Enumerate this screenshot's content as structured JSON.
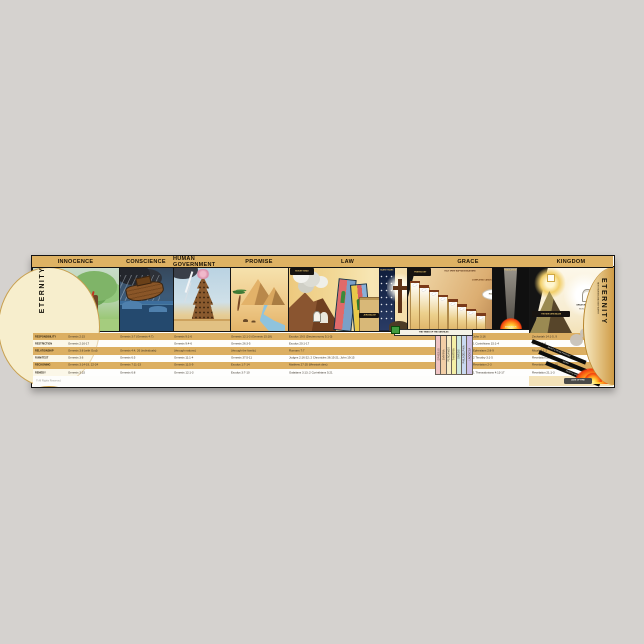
{
  "page": {
    "background": "#d5d2cf"
  },
  "poster": {
    "eternity_left": "ETERNITY",
    "eternity_right": "ETERNITY",
    "eternity_right_sub": "NEW HEAVEN AND NEW EARTH",
    "copyright": "© All Rights Reserved.",
    "colors": {
      "header_gold": "#deb263",
      "row_gold": "#dcaf62",
      "cream": "#f7eecd"
    }
  },
  "sections": [
    {
      "label": "INNOCENCE"
    },
    {
      "label": "CONSCIENCE"
    },
    {
      "label": "HUMAN GOVERNMENT"
    },
    {
      "label": "PROMISE"
    },
    {
      "label": "LAW"
    },
    {
      "label": "GRACE"
    },
    {
      "label": "KINGDOM"
    }
  ],
  "table": {
    "row_labels": [
      "RESPONSIBILITY",
      "RESTRICTION",
      "RELATIONSHIP",
      "RUIN/TEST",
      "RECKONING",
      "REMEDY"
    ],
    "columns": [
      {
        "section": "INNOCENCE",
        "refs": [
          "Genesis 2:15",
          "Genesis 2:16-17",
          "Genesis 3:8 (with God)",
          "Genesis 3:6",
          "Genesis 3:14-19, 22-24",
          "Genesis 3:15"
        ]
      },
      {
        "section": "CONSCIENCE",
        "refs": [
          "Genesis 3:7 (Genesis 4:7)",
          "",
          "Genesis 4:4, 26 (individuals)",
          "Genesis 6:5",
          "Genesis 7:11-23",
          "Genesis 6:8"
        ]
      },
      {
        "section": "HUMAN GOVERNMENT",
        "refs": [
          "Genesis 9:1-6",
          "Genesis 9:4-6",
          "(through nations)",
          "Genesis 11:1-4",
          "Genesis 11:5-9",
          "Genesis 12:1-3"
        ]
      },
      {
        "section": "PROMISE",
        "refs": [
          "Genesis 12:1-3 (Genesis 15:18)",
          "Genesis 26:3-5",
          "(through the family)",
          "Genesis 37:5-11",
          "Exodus 1:7-14",
          "Exodus 3:7-10"
        ]
      },
      {
        "section": "LAW",
        "refs": [
          "Exodus 19:5 (Deuteronomy 5:1-3)",
          "Exodus 20:1-17",
          "Romans 7:7",
          "Judges 2:16-22; 2 Chronicles 36:15-21; John 19:15",
          "Matthew 27:35 (Messiah dies)",
          "Galatians 3:13; 2 Corinthians 5:21"
        ]
      },
      {
        "section": "GRACE",
        "refs": [
          "John 3:16",
          "1 Corinthians 15:1-4",
          "Ephesians 2:8-9",
          "2 Timothy 3:1-5",
          "Revelation 2-3",
          "1 Thessalonians 4:13-17"
        ]
      },
      {
        "section": "KINGDOM",
        "refs": [
          "Zechariah 14:1-5, 9",
          "Isaiah 11:4",
          "Micah 4:1-2",
          "Revelation 20:7-9a",
          "Revelation 20:9b-10",
          "Revelation 21:1-3"
        ]
      }
    ]
  },
  "law": {
    "mount_sinai": "MOUNT SINAI",
    "jerusalem": "JERUSALEM",
    "silent_years": "SILENT YEARS"
  },
  "grace": {
    "pentecost": "PENTECOST",
    "spirit_line": "HOLY SPIRIT BAPTIZES BELIEVERS",
    "canon_line": "COMPLETED CANON",
    "rapture": "RAPTURE",
    "tribulation": "TRIBULATION",
    "armageddon": "ARMAGEDDON",
    "gentiles_band": "THE TIMES OF THE GENTILES",
    "churches": [
      {
        "name": "EPHESUS",
        "color": "#efc3c3"
      },
      {
        "name": "SMYRNA",
        "color": "#f3cfa6"
      },
      {
        "name": "PERGAMOS",
        "color": "#f6ecc5"
      },
      {
        "name": "THYATIRA",
        "color": "#f4efa5"
      },
      {
        "name": "SARDIS",
        "color": "#cfe9df"
      },
      {
        "name": "PHILADELPHIA",
        "color": "#c9d9f1"
      },
      {
        "name": "LAODICEA",
        "color": "#cec0e6"
      }
    ]
  },
  "kingdom": {
    "new_jerusalem": "THE NEW JERUSALEM",
    "white_throne": "GREAT WHITE THRONE",
    "white_throne_sub": "REVELATION 20:11-15",
    "lake_of_fire": "LAKE OF FIRE",
    "beams": [
      "BEAST & FALSE PROPHET",
      "SATAN",
      "DEATH & HADES"
    ]
  }
}
